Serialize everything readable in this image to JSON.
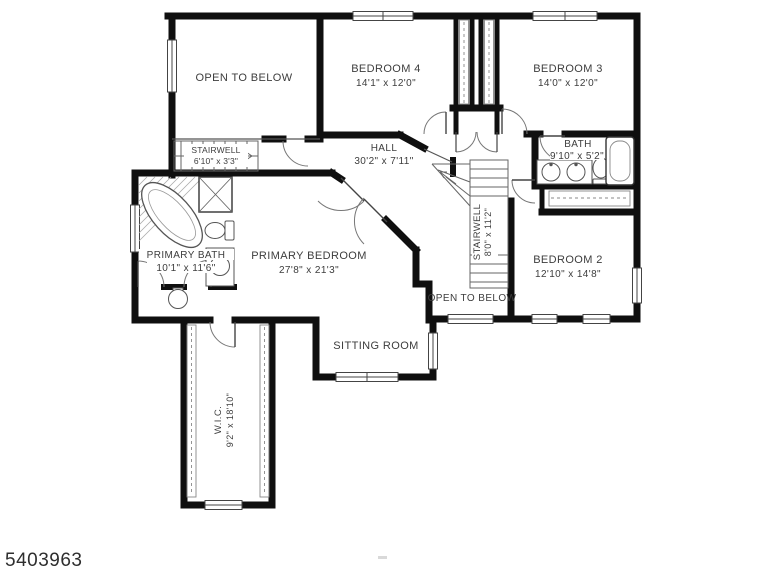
{
  "watermark": "5403963",
  "colors": {
    "wall": "#0f0f0f",
    "thin_line": "#555555",
    "fixture_line": "#666666",
    "label_text": "#3d3d3d",
    "background": "#ffffff"
  },
  "rooms": [
    {
      "name": "open-to-below-upper",
      "label": "OPEN TO BELOW",
      "dims": ""
    },
    {
      "name": "bedroom-4",
      "label": "BEDROOM 4",
      "dims": "14'1\" x 12'0\""
    },
    {
      "name": "bedroom-3",
      "label": "BEDROOM 3",
      "dims": "14'0\" x 12'0\""
    },
    {
      "name": "stairwell-small",
      "label": "STAIRWELL",
      "dims": "6'10\" x 3'3\""
    },
    {
      "name": "hall",
      "label": "HALL",
      "dims": "30'2\" x 7'11\""
    },
    {
      "name": "bath",
      "label": "BATH",
      "dims": "9'10\" x 5'2\""
    },
    {
      "name": "primary-bath",
      "label": "PRIMARY BATH",
      "dims": "10'1\" x 11'6\""
    },
    {
      "name": "primary-bedroom",
      "label": "PRIMARY BEDROOM",
      "dims": "27'8\" x 21'3\""
    },
    {
      "name": "stairwell-main",
      "label": "STAIRWELL",
      "dims": "8'0\" x 11'2\""
    },
    {
      "name": "bedroom-2",
      "label": "BEDROOM 2",
      "dims": "12'10\" x 14'8\""
    },
    {
      "name": "open-to-below-lower",
      "label": "OPEN TO BELOW",
      "dims": ""
    },
    {
      "name": "sitting-room",
      "label": "SITTING ROOM",
      "dims": ""
    },
    {
      "name": "wic",
      "label": "W.I.C.",
      "dims": "9'2\" x 18'10\""
    }
  ]
}
